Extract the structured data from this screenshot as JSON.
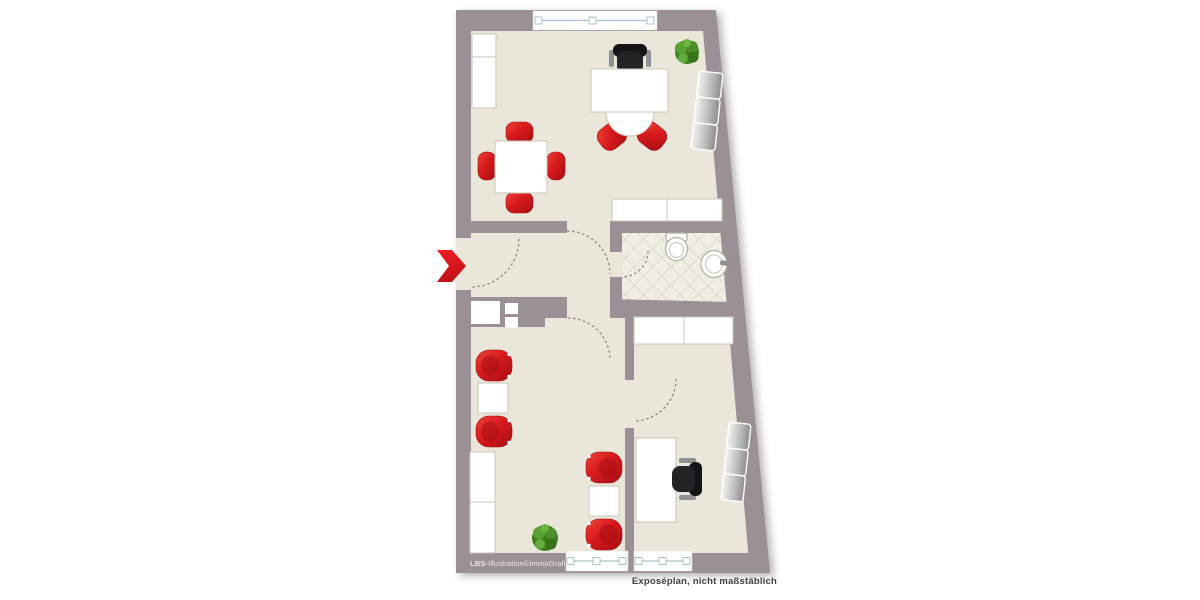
{
  "annotations": {
    "credit_brand": "LBS",
    "credit_suffix": "-Illustration©immoGrafik",
    "disclaimer": "Exposéplan, nicht maßstäblich"
  },
  "colors": {
    "background": "#ffffff",
    "wall": "#9b9095",
    "floor": "#eae6da",
    "tile": "#f0ede3",
    "tile_line": "#ccc7ba",
    "furniture_white": "#ffffff",
    "furniture_border": "#c9c4b6",
    "accent_red": "#d91a1c",
    "window_line": "#a9c4cc",
    "chair_black": "#232326",
    "sofa_silver": "#c0c0c0",
    "plant_green": "#4d8f27",
    "disclaimer_color": "#414141",
    "credit_color": "#eae8ea"
  },
  "legend": {
    "type": "apartment-floor-plan",
    "windows": 3,
    "door_swings": 5,
    "rooms": [
      {
        "id": "room-top",
        "furniture": [
          "wardrobe",
          "dining-table",
          "dining-chair x4",
          "desk",
          "desk-round-extension",
          "office-chair",
          "visitor-chair x2",
          "plant",
          "sofa-3-seat",
          "sideboard",
          "window"
        ]
      },
      {
        "id": "hallway",
        "furniture": [
          "entrance-arrow",
          "built-in-closet"
        ]
      },
      {
        "id": "bathroom",
        "furniture": [
          "toilet",
          "washbasin",
          "tiled-floor"
        ]
      },
      {
        "id": "room-bottom-left",
        "furniture": [
          "armchair x2",
          "side-table",
          "armchair x2",
          "side-table",
          "cabinet",
          "plant",
          "window"
        ]
      },
      {
        "id": "room-bottom-right",
        "furniture": [
          "sideboard",
          "desk",
          "office-chair",
          "sofa-3-seat",
          "window"
        ]
      }
    ]
  }
}
